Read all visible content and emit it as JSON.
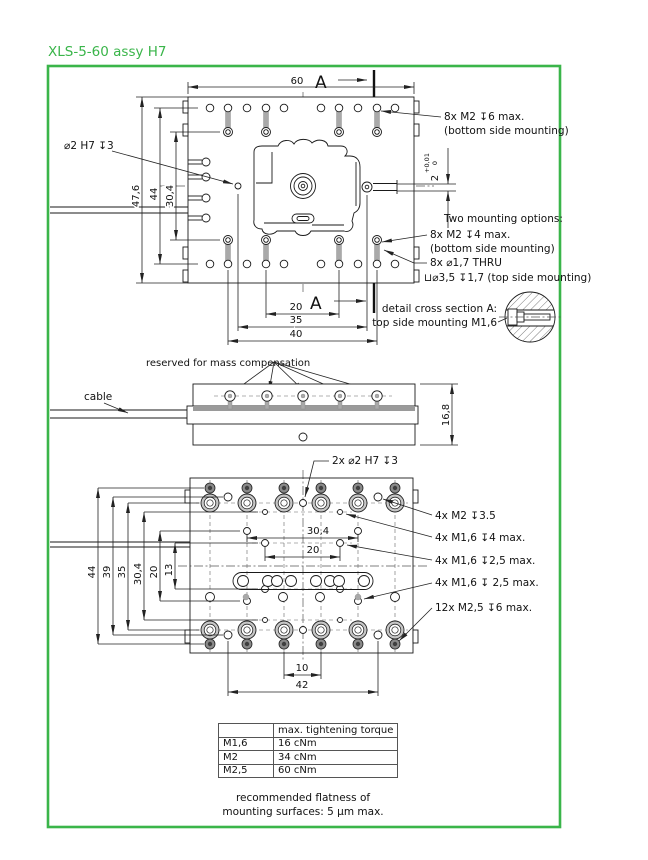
{
  "title": "XLS-5-60 assy H7",
  "top": {
    "dim60": "60",
    "a": "A",
    "d476": "47,6",
    "d44": "44",
    "d304": "30,4",
    "d20": "20",
    "d35": "35",
    "d40": "40",
    "pin": "⌀2  H7 ↧3",
    "step2": "2",
    "tolUp": "+0,01",
    "tolDn": "0",
    "n1": "8x  M2  ↧6 max.",
    "n1b": "(bottom side mounting)",
    "optT": "Two mounting options:",
    "o1": "8x  M2  ↧4 max.",
    "o1b": "(bottom side mounting)",
    "o2": "8x  ⌀1,7  THRU",
    "o2b": "⊔⌀3,5 ↧1,7 (top side mounting)",
    "det1": "detail cross section A:",
    "det2": "top side mounting M1,6"
  },
  "mid": {
    "mass": "reserved for mass compensation",
    "cable": "cable",
    "d168": "16,8"
  },
  "bot": {
    "pin": "2x  ⌀2  H7 ↧3",
    "d44": "44",
    "d39": "39",
    "d35": "35",
    "d304v": "30,4",
    "d20v": "20",
    "d13": "13",
    "d304h": "30,4",
    "d20h": "20",
    "d10": "10",
    "d42": "42",
    "n1": "4x  M2  ↧3.5",
    "n2": "4x  M1,6  ↧4 max.",
    "n3": "4x  M1,6  ↧2,5 max.",
    "n4": "4x  M1,6  ↧ 2,5 max.",
    "n5": "12x  M2,5  ↧6 max."
  },
  "table": {
    "h2": "max. tightening torque",
    "r": [
      [
        "M1,6",
        "16 cNm"
      ],
      [
        "M2",
        "34 cNm"
      ],
      [
        "M2,5",
        "60 cNm"
      ]
    ]
  },
  "footer": {
    "l1": "recommended flatness of",
    "l2": "mounting surfaces: 5 µm max."
  }
}
